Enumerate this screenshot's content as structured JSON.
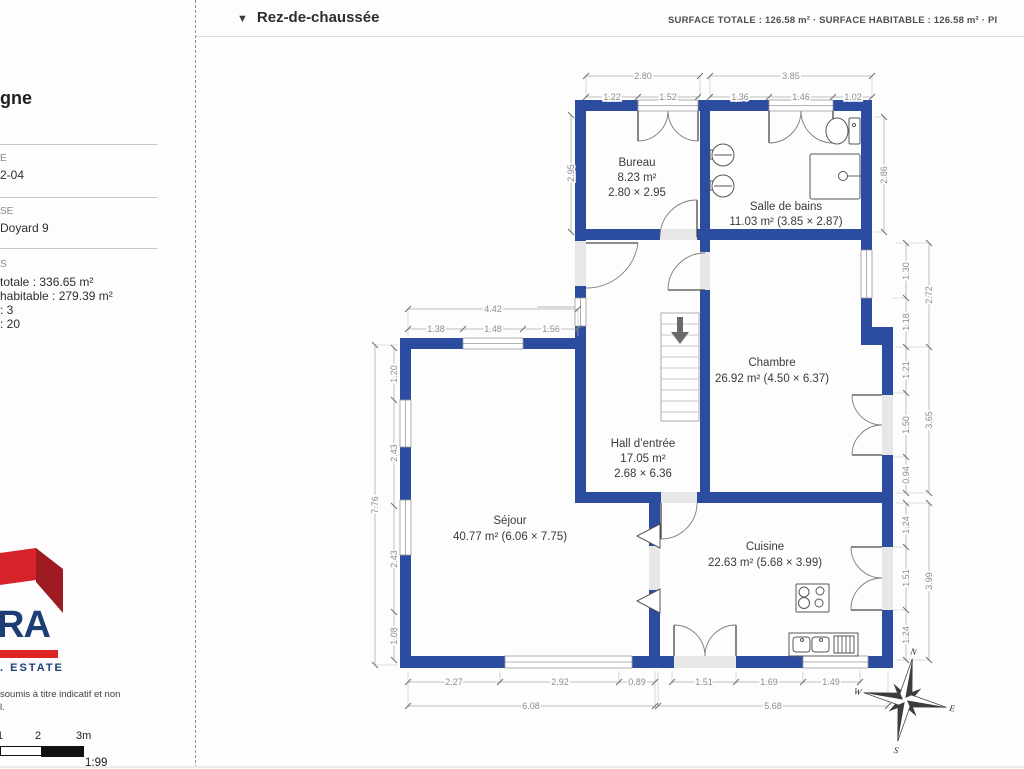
{
  "header": {
    "collapse_icon": "▼",
    "title": "Rez-de-chaussée",
    "summary": "SURFACE TOTALE : 126.58 m² · SURFACE HABITABLE : 126.58 m² · PI"
  },
  "sidebar": {
    "title_fragment": "gne",
    "field1_label": "E",
    "field1_value": "2-04",
    "field2_label": "SE",
    "field2_value": "Doyard 9",
    "field3_label": "S",
    "info_lines": [
      "totale : 336.65 m²",
      "habitable : 279.39 m²",
      ": 3",
      ": 20"
    ],
    "logo_text": "RA",
    "logo_sub": ". ESTATE",
    "disclaimer_line1": "soumis à titre indicatif et non",
    "disclaimer_line2": "l.",
    "scale_labels": [
      "1",
      "2",
      "3m"
    ],
    "scale_ratio": "1:99"
  },
  "plan": {
    "rooms": {
      "bureau": {
        "name": "Bureau",
        "area": "8.23 m²",
        "size": "2.80 × 2.95"
      },
      "salle_de_bains": {
        "name": "Salle de bains",
        "area": "11.03 m² (3.85 × 2.87)"
      },
      "chambre": {
        "name": "Chambre",
        "area": "26.92 m² (4.50 × 6.37)"
      },
      "hall": {
        "name": "Hall d’entrée",
        "area": "17.05 m²",
        "size": "2.68 × 6.36"
      },
      "sejour": {
        "name": "Séjour",
        "area": "40.77 m² (6.06 × 7.75)"
      },
      "cuisine": {
        "name": "Cuisine",
        "area": "22.63 m² (5.68 × 3.99)"
      }
    },
    "dims": {
      "bureau_top": "2.80",
      "bureau_top_sub": [
        "1.22",
        "1.52"
      ],
      "sdb_top": "3.85",
      "sdb_top_sub": [
        "1.36",
        "1.46",
        "1.02"
      ],
      "bureau_left": "2.95",
      "sdb_right": "2.86",
      "sejour_top": "4.42",
      "sejour_top_sub": [
        "1.38",
        "1.48",
        "1.56"
      ],
      "sejour_left": "7.76",
      "sejour_left_sub": [
        "1.20",
        "2.43",
        "2.43",
        "1.08"
      ],
      "chambre_right_sub": [
        "1.30",
        "1.18",
        "1.21",
        "1.50",
        "0.94"
      ],
      "chambre_right": [
        "2.72",
        "3.65"
      ],
      "cuisine_right_sub": [
        "1.24",
        "1.51",
        "1.24"
      ],
      "cuisine_right": "3.99",
      "sejour_bottom_sub": [
        "2.27",
        "2.92",
        "0.89"
      ],
      "sejour_bottom": "6.08",
      "cuisine_bottom_sub": [
        "1.51",
        "1.69",
        "1.49"
      ],
      "cuisine_bottom": "5.68"
    },
    "compass": {
      "n": "N",
      "e": "E",
      "s": "S",
      "w": "W"
    },
    "wall_color": "#2b4c9f"
  }
}
